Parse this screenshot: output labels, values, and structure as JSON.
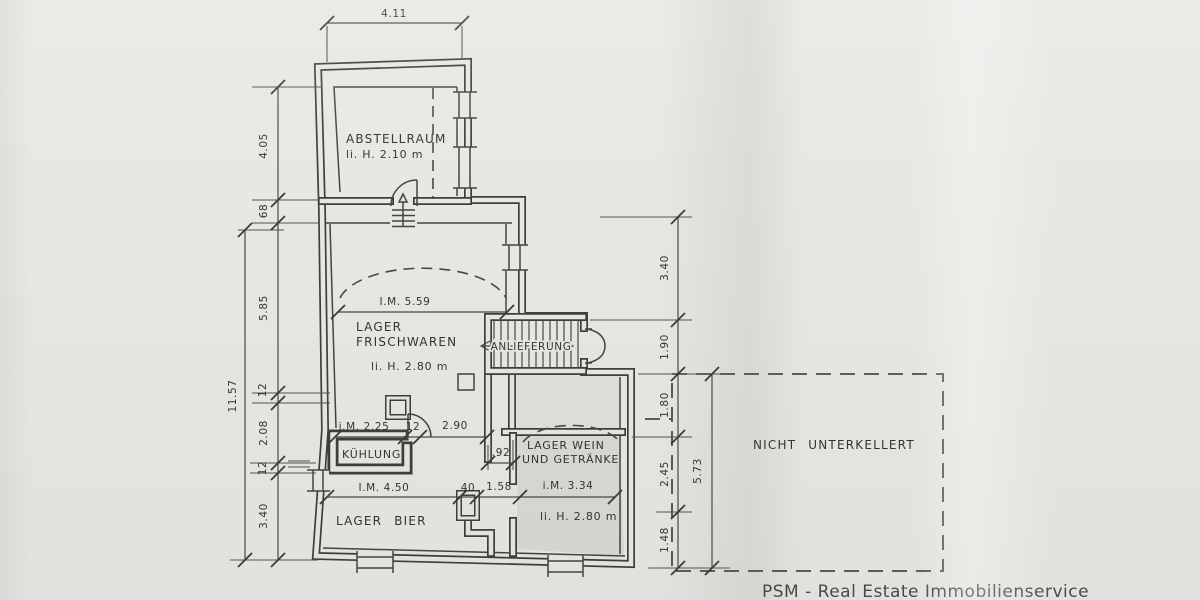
{
  "rooms": {
    "abstellraum": {
      "name": "ABSTELLRAUM",
      "height": "li. H. 2.10 m"
    },
    "frischwaren": {
      "line1": "LAGER",
      "line2": "FRISCHWAREN",
      "height": "li. H. 2.80 m"
    },
    "anlieferung": {
      "name": "ANLIEFERUNG"
    },
    "kuehlung": {
      "name": "KÜHLUNG"
    },
    "wein": {
      "line1": "LAGER WEIN",
      "line2": "UND GETRÄNKE",
      "height": "li. H. 2.80 m"
    },
    "bier": {
      "name": "LAGER BIER"
    },
    "nicht": {
      "name": "NICHT UNTERKELLERT"
    }
  },
  "dimensions": {
    "top_width": "4.11",
    "left_total": "11.57",
    "left_chain": [
      "4.05",
      "68",
      "5.85",
      "12",
      "2.08",
      "12",
      "3.40"
    ],
    "right_chain": [
      "3.40",
      "1.90",
      "1.80",
      "2.45",
      "1.48"
    ],
    "right_total": "5.73",
    "frischwaren_width": "I.M. 5.59",
    "kuehlung_width": "i.M. 2.25",
    "kuehlung_wall": "12",
    "passage_width": "2.90",
    "delivery_width": ".92",
    "bier_width": "I.M. 4.50",
    "pillar_width": "40",
    "opening_width": "1.58",
    "wein_width": "i.M. 3.34"
  },
  "footer": {
    "text": "PSM - Real Estate Immobilienservice"
  },
  "colors": {
    "line": "#3f3e3b",
    "paper": "#e8e7e3",
    "shade": "#d7d6d0"
  }
}
